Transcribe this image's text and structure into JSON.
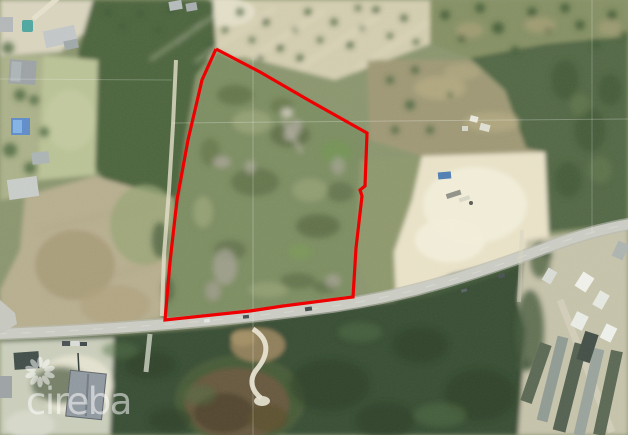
{
  "watermark": {
    "text": "cireba",
    "logo_icon": "starburst-flower-icon",
    "color": "#ffffff",
    "opacity": 0.52
  },
  "overlay": {
    "parcel_boundary": {
      "color": "#ee0000",
      "stroke_width": 3.2,
      "points": [
        [
          216,
          49
        ],
        [
          260,
          72
        ],
        [
          310,
          101
        ],
        [
          367,
          133
        ],
        [
          365,
          186
        ],
        [
          360,
          190
        ],
        [
          362,
          196
        ],
        [
          356,
          248
        ],
        [
          353,
          297
        ],
        [
          283,
          306
        ],
        [
          250,
          311
        ],
        [
          165,
          320
        ],
        [
          170,
          262
        ],
        [
          177,
          200
        ],
        [
          188,
          140
        ],
        [
          202,
          80
        ],
        [
          216,
          49
        ]
      ]
    }
  }
}
